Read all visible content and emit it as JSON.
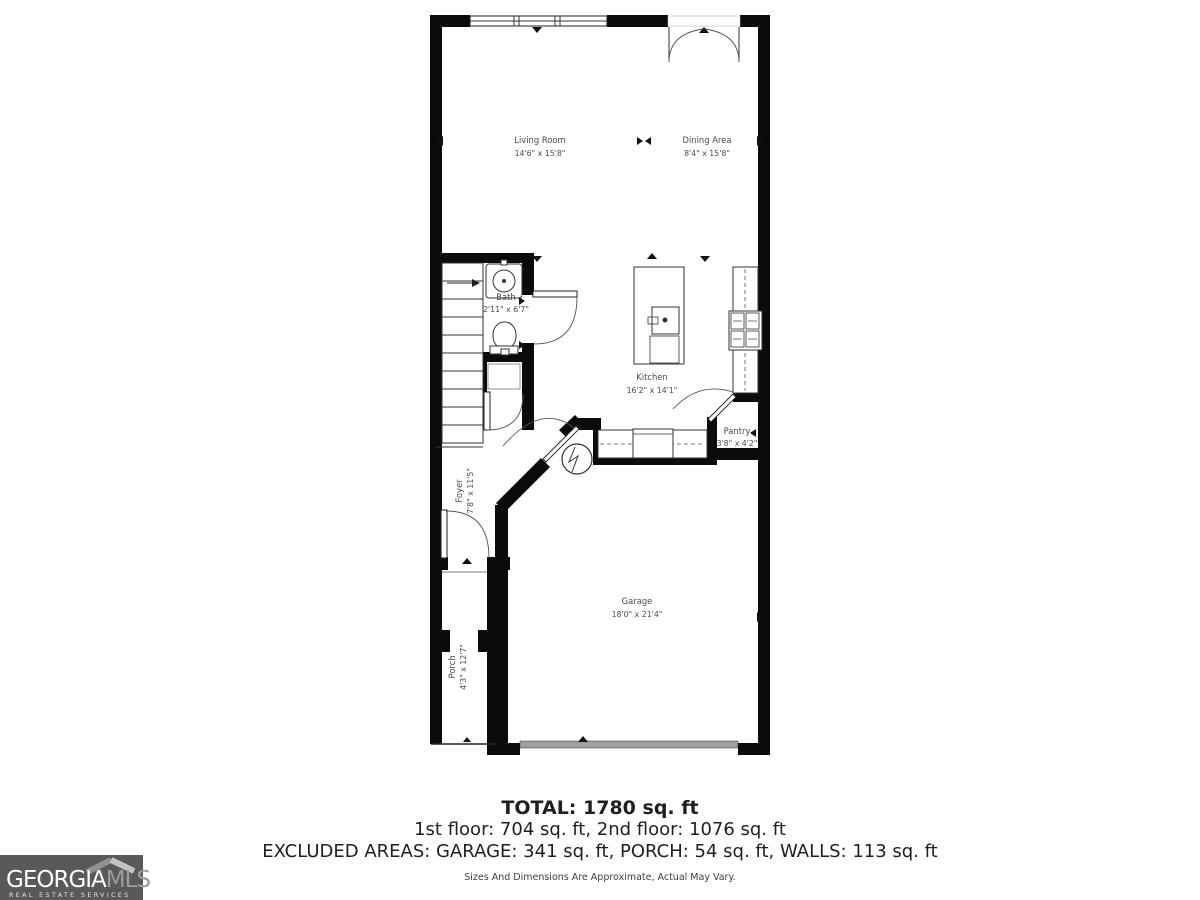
{
  "floorplan": {
    "rooms": {
      "living_room": {
        "name": "Living Room",
        "dims": "14'6\" x 15'8\""
      },
      "dining_area": {
        "name": "Dining Area",
        "dims": "8'4\" x 15'8\""
      },
      "bath": {
        "name": "Bath",
        "dims": "2'11\" x 6'7\""
      },
      "kitchen": {
        "name": "Kitchen",
        "dims": "16'2\" x 14'1\""
      },
      "pantry": {
        "name": "Pantry",
        "dims": "3'8\" x 4'2\""
      },
      "foyer": {
        "name": "Foyer",
        "dims": "7'8\" x 11'5\""
      },
      "garage": {
        "name": "Garage",
        "dims": "18'0\" x 21'4\""
      },
      "porch": {
        "name": "Porch",
        "dims": "4'3\" x 12'7\""
      }
    }
  },
  "summary": {
    "total": "TOTAL: 1780 sq. ft",
    "floors": "1st floor: 704 sq. ft, 2nd floor: 1076 sq. ft",
    "excluded": "EXCLUDED AREAS: GARAGE: 341 sq. ft, PORCH: 54 sq. ft, WALLS: 113 sq. ft",
    "disclaimer": "Sizes And Dimensions Are Approximate, Actual May Vary."
  },
  "branding": {
    "name_part1": "GEORGIA",
    "name_part2": "MLS",
    "tagline": "REAL ESTATE SERVICES",
    "colors": {
      "logo_bg": "#58595b",
      "name1": "#ffffff",
      "name2": "#9b9c9e",
      "roof_left": "#909193",
      "roof_right": "#c2c3c5",
      "garage_door": "#a0a0a0"
    }
  }
}
